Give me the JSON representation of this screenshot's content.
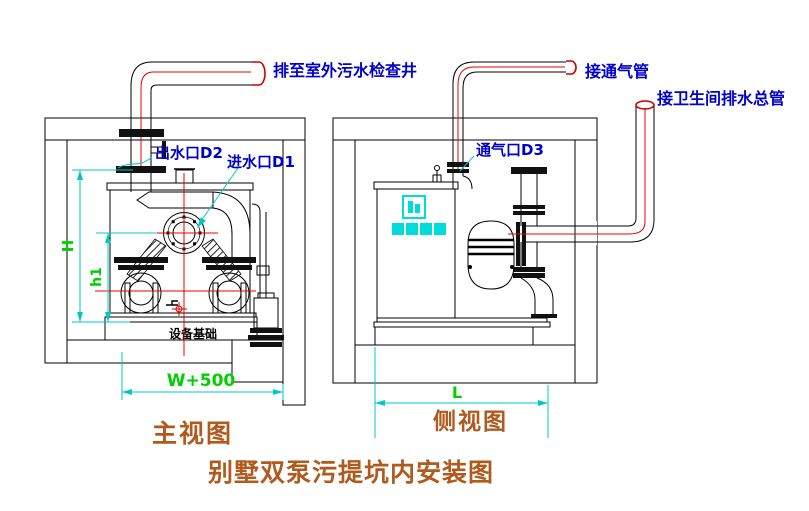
{
  "drawing": {
    "title": "别墅双泵污提坑内安装图",
    "front_view": {
      "caption": "主视图",
      "labels": {
        "discharge_note": "排至室外污水检查井",
        "outlet_port": "出水口D2",
        "inlet_port": "进水口D1",
        "foundation": "设备基础"
      },
      "dimensions": {
        "height_total": "H",
        "height_pump": "h1",
        "pit_width": "W+500"
      }
    },
    "side_view": {
      "caption": "侧视图",
      "labels": {
        "vent_note": "接通气管",
        "inlet_note": "接卫生间排水总管",
        "vent_port": "通气口D3"
      },
      "dimensions": {
        "pit_length": "L"
      }
    },
    "colors": {
      "line": "#000000",
      "centerline": "#e80000",
      "dimension_line": "#00c8c8",
      "dimension_text": "#00cf00",
      "label_text": "#0000cc",
      "caption_text": "#b05a1e",
      "logo": "#00dcdc"
    }
  }
}
